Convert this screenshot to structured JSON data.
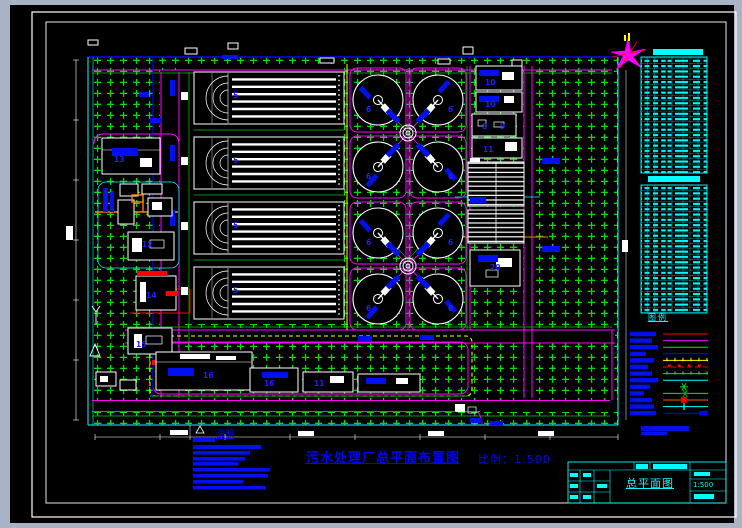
{
  "drawing": {
    "main_title": "污水处理厂总平面布置图",
    "scale_text": "比例：1:500",
    "notes_title": "说明",
    "legend_title": "图例",
    "titleblock": {
      "name": "总平面图",
      "scale": "1:500"
    },
    "colors": {
      "background": "#000000",
      "frame_white": "#ffffff",
      "grass_green": "#00dd00",
      "road_magenta": "#ff00ff",
      "boundary_cyan": "#00ffff",
      "label_blue": "#0010ee",
      "title_blue": "#0000ff",
      "accent_yellow": "#ffff00",
      "accent_red": "#ff0000",
      "pipe_orange": "#ff7f00",
      "table_cyan": "#00ffff"
    },
    "tables": [
      {
        "name": "table-upper",
        "rows": 22
      },
      {
        "name": "table-lower",
        "rows": 24
      }
    ],
    "plan_labels": [
      {
        "text": "5",
        "x": 233,
        "y": 98
      },
      {
        "text": "5",
        "x": 233,
        "y": 163
      },
      {
        "text": "5",
        "x": 233,
        "y": 228
      },
      {
        "text": "5",
        "x": 233,
        "y": 293
      },
      {
        "text": "6",
        "x": 366,
        "y": 112
      },
      {
        "text": "6",
        "x": 448,
        "y": 112
      },
      {
        "text": "6",
        "x": 366,
        "y": 179
      },
      {
        "text": "6",
        "x": 448,
        "y": 179
      },
      {
        "text": "6",
        "x": 366,
        "y": 245
      },
      {
        "text": "6",
        "x": 448,
        "y": 245
      },
      {
        "text": "6",
        "x": 366,
        "y": 311
      },
      {
        "text": "6",
        "x": 448,
        "y": 311
      },
      {
        "text": "10",
        "x": 485,
        "y": 85
      },
      {
        "text": "10",
        "x": 485,
        "y": 107
      },
      {
        "text": "8",
        "x": 482,
        "y": 129
      },
      {
        "text": "9",
        "x": 500,
        "y": 129
      },
      {
        "text": "11",
        "x": 483,
        "y": 152
      },
      {
        "text": "20",
        "x": 490,
        "y": 270
      },
      {
        "text": "16",
        "x": 203,
        "y": 378
      },
      {
        "text": "16",
        "x": 264,
        "y": 386
      },
      {
        "text": "11",
        "x": 314,
        "y": 386
      },
      {
        "text": "13",
        "x": 114,
        "y": 162
      },
      {
        "text": "12",
        "x": 142,
        "y": 247
      },
      {
        "text": "14",
        "x": 146,
        "y": 298
      },
      {
        "text": "15",
        "x": 136,
        "y": 347
      }
    ],
    "legend": {
      "items": [
        {
          "type": "line",
          "color": "#ff0000",
          "label_w": 26
        },
        {
          "type": "line",
          "color": "#ff00ff",
          "label_w": 22
        },
        {
          "type": "line",
          "color": "#00ee00",
          "label_w": 28
        },
        {
          "type": "line",
          "color": "#0000ff",
          "label_w": 16
        },
        {
          "type": "line-ticks",
          "color": "#ffff00",
          "label_w": 24
        },
        {
          "type": "line-squares",
          "color": "#ff0000",
          "label_w": 18
        },
        {
          "type": "line-ticks",
          "color": "#00ee00",
          "label_w": 22
        },
        {
          "type": "line",
          "color": "#00ffff",
          "label_w": 28
        },
        {
          "type": "symbol",
          "color": "#00cc00",
          "label_w": 20
        },
        {
          "type": "line-symbol",
          "color": "#00ee00",
          "symbol_color": "#00aa00",
          "label_w": 14
        },
        {
          "type": "line-square",
          "color": "#ff5500",
          "symbol_color": "#ff0000",
          "label_w": 22
        },
        {
          "type": "line-tick",
          "color": "#00ffff",
          "symbol_color": "#00ffff",
          "label_w": 24
        },
        {
          "type": "line-arrow",
          "color": "#0000ff",
          "symbol_color": "#0000ff",
          "label_w": 26
        }
      ]
    }
  }
}
